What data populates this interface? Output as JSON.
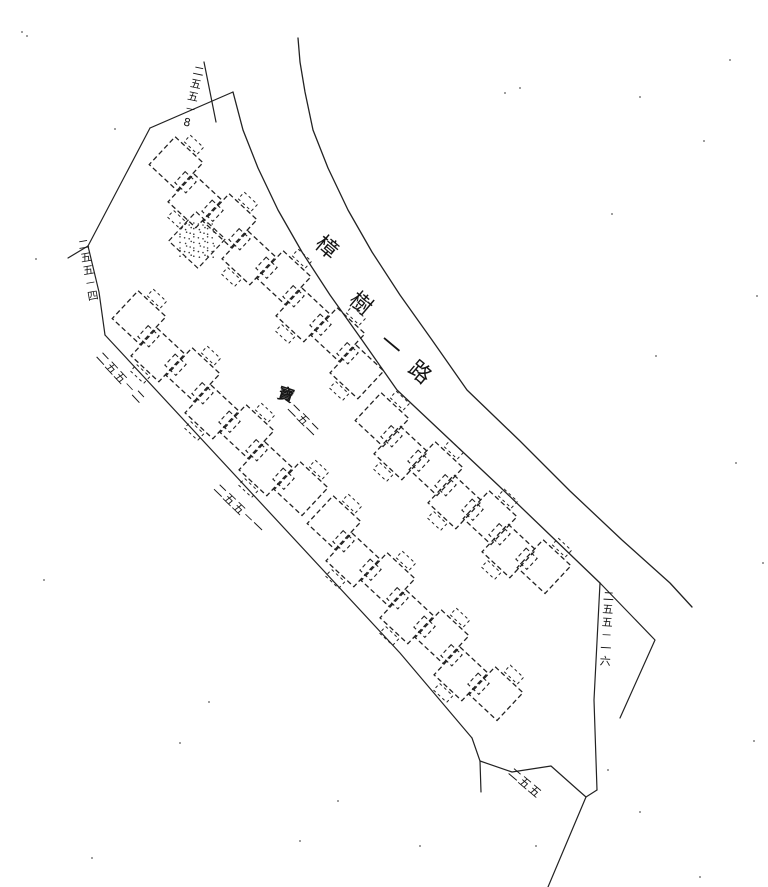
{
  "map": {
    "type": "cadastral-plan-scan",
    "background": "#ffffff",
    "ink": "#222222",
    "text_ink": "#151515",
    "road": {
      "name": "樟樹一路",
      "chars": [
        {
          "ch": "樟",
          "x": 317,
          "y": 230,
          "rot": 40,
          "size": 22
        },
        {
          "ch": "樹",
          "x": 351,
          "y": 286,
          "rot": 40,
          "size": 22
        },
        {
          "ch": "一",
          "x": 381,
          "y": 328,
          "rot": 40,
          "size": 22
        },
        {
          "ch": "路",
          "x": 410,
          "y": 355,
          "rot": 40,
          "size": 22
        }
      ],
      "inner_edge": [
        [
          233,
          92
        ],
        [
          243,
          130
        ],
        [
          258,
          168
        ],
        [
          278,
          210
        ],
        [
          302,
          252
        ],
        [
          330,
          295
        ],
        [
          362,
          340
        ],
        [
          397,
          390
        ],
        [
          448,
          438
        ],
        [
          499,
          486
        ],
        [
          550,
          535
        ],
        [
          600,
          583
        ]
      ],
      "outer_edge": [
        [
          298,
          38
        ],
        [
          300,
          62
        ],
        [
          305,
          92
        ],
        [
          313,
          130
        ],
        [
          328,
          168
        ],
        [
          348,
          210
        ],
        [
          372,
          252
        ],
        [
          400,
          295
        ],
        [
          432,
          340
        ],
        [
          467,
          390
        ],
        [
          520,
          441
        ],
        [
          570,
          491
        ],
        [
          622,
          540
        ],
        [
          670,
          583
        ],
        [
          692,
          607
        ]
      ]
    },
    "parcel": {
      "segments": {
        "top-edge": [
          [
            150,
            128
          ],
          [
            233,
            92
          ]
        ],
        "top-spur": [
          [
            204,
            62
          ],
          [
            216,
            122
          ]
        ],
        "west-edge": [
          [
            150,
            128
          ],
          [
            88,
            246
          ]
        ],
        "west-spur": [
          [
            88,
            246
          ],
          [
            68,
            258
          ]
        ],
        "west-edge-2": [
          [
            88,
            246
          ],
          [
            99,
            292
          ],
          [
            105,
            335
          ]
        ],
        "southwest-edge": [
          [
            105,
            335
          ],
          [
            400,
            653
          ],
          [
            472,
            738
          ]
        ],
        "bottom-edge": [
          [
            472,
            738
          ],
          [
            480,
            761
          ],
          [
            512,
            772
          ],
          [
            551,
            766
          ],
          [
            578,
            790
          ],
          [
            586,
            797
          ],
          [
            597,
            790
          ]
        ],
        "bottom-spur": [
          [
            480,
            761
          ],
          [
            481,
            792
          ]
        ],
        "east-edge": [
          [
            597,
            790
          ],
          [
            594,
            700
          ],
          [
            600,
            583
          ]
        ],
        "bottom-exit": [
          [
            586,
            797
          ],
          [
            548,
            887
          ]
        ],
        "triangle-edge": [
          [
            600,
            583
          ],
          [
            655,
            640
          ],
          [
            620,
            718
          ]
        ]
      }
    },
    "labels": [
      {
        "name": "lot-label-255-8",
        "text": "二五五－8",
        "x": 193,
        "y": 64,
        "rot": 12,
        "vertical": true,
        "size": 11
      },
      {
        "name": "lot-label-255-4",
        "text": "二五五－四",
        "x": 76,
        "y": 240,
        "rot": -10,
        "vertical": true,
        "size": 11
      },
      {
        "name": "lot-label-255-2",
        "text": "二五五－二",
        "x": 103,
        "y": 350,
        "rot": 47,
        "vertical": false,
        "size": 12
      },
      {
        "name": "lot-label-255-1",
        "text": "二五五－一",
        "x": 220,
        "y": 482,
        "rot": 44,
        "vertical": false,
        "size": 12
      },
      {
        "name": "lot-label-255-16",
        "text": "二五五－一六",
        "x": 602,
        "y": 590,
        "rot": 3,
        "vertical": true,
        "size": 11
      },
      {
        "name": "lot-label-255",
        "text": "二五五",
        "x": 514,
        "y": 766,
        "rot": 40,
        "vertical": false,
        "size": 12
      },
      {
        "name": "lot-label-252",
        "text": "二五二",
        "x": 294,
        "y": 402,
        "rot": 45,
        "vertical": false,
        "size": 12
      },
      {
        "name": "parcel-mark",
        "text": "寶",
        "x": 281,
        "y": 384,
        "rot": 18,
        "vertical": false,
        "size": 16,
        "bold": true
      }
    ],
    "buildings": {
      "style": {
        "size": 38,
        "small": 15,
        "flank_w": 18,
        "flank_h": 9,
        "rot": 43,
        "dash": "5 3",
        "stroke_w": 1.3
      },
      "chains": [
        {
          "name": "north-row-upper",
          "x": 172,
          "y": 168,
          "count": 8,
          "dx": 27,
          "dy": 28.5
        },
        {
          "name": "north-row-lower",
          "x": 378,
          "y": 424,
          "count": 7,
          "dx": 27,
          "dy": 24.5
        },
        {
          "name": "south-row-upper",
          "x": 135,
          "y": 322,
          "count": 7,
          "dx": 27,
          "dy": 28.5
        },
        {
          "name": "south-row-lower",
          "x": 330,
          "y": 527,
          "count": 7,
          "dx": 27,
          "dy": 28.5
        }
      ],
      "stipple_block": {
        "x": 197,
        "y": 240,
        "size": 40
      }
    },
    "noise_specks": [
      [
        22,
        32
      ],
      [
        27,
        36
      ],
      [
        520,
        88
      ],
      [
        640,
        97
      ],
      [
        704,
        141
      ],
      [
        612,
        214
      ],
      [
        757,
        296
      ],
      [
        736,
        463
      ],
      [
        44,
        580
      ],
      [
        36,
        259
      ],
      [
        209,
        702
      ],
      [
        300,
        841
      ],
      [
        536,
        846
      ],
      [
        640,
        812
      ],
      [
        763,
        563
      ],
      [
        700,
        877
      ],
      [
        180,
        743
      ],
      [
        92,
        858
      ],
      [
        420,
        846
      ],
      [
        608,
        770
      ],
      [
        338,
        801
      ],
      [
        754,
        741
      ],
      [
        115,
        129
      ],
      [
        656,
        356
      ],
      [
        730,
        60
      ],
      [
        505,
        93
      ]
    ]
  }
}
